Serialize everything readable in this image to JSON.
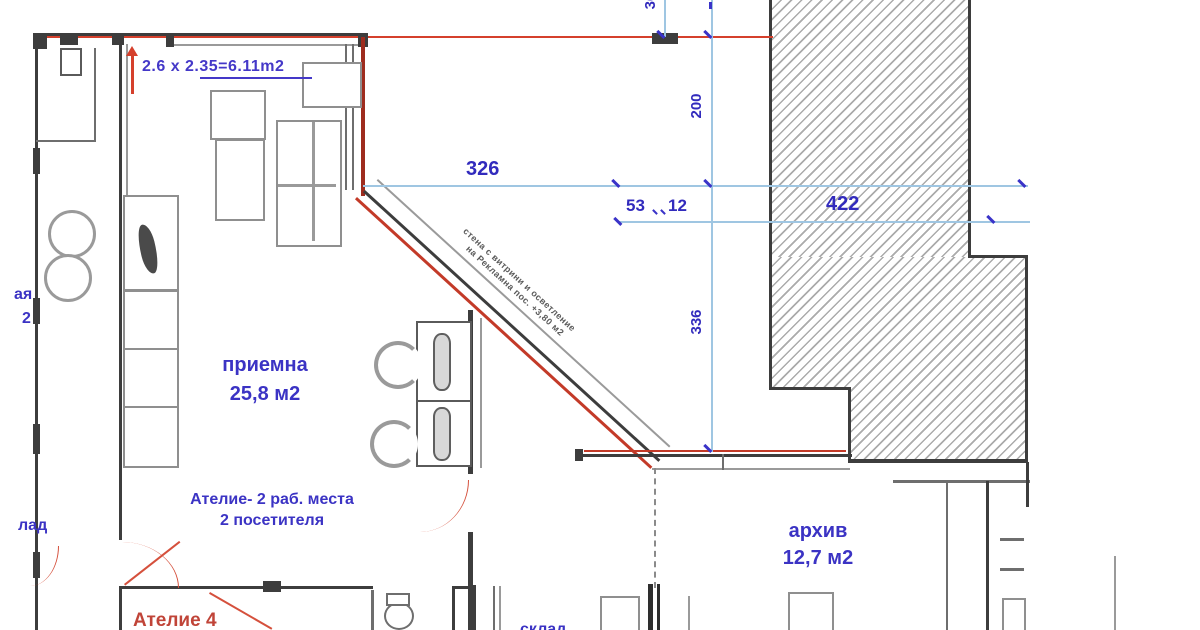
{
  "colors": {
    "dim_line": "#9fc6e2",
    "dim_text": "#322bbd",
    "label_blue": "#3b33c4",
    "red_line": "#d5402c",
    "dark_red": "#9e2c1e",
    "wall": "#3d3d3d",
    "red_text": "#c04438"
  },
  "dimensions": {
    "top_small": "36",
    "width_326": "326",
    "width_53": "53",
    "width_12": "12",
    "width_422": "422",
    "height_200": "200",
    "height_336": "336"
  },
  "annotations": {
    "area_calc": "2.6 x 2.35=6.11m2",
    "diag_note_line1": "стена с витрини и осветление",
    "diag_note_line2": "на Рекламна пос. +3,80 м2"
  },
  "rooms": {
    "reception": {
      "name": "приемна",
      "area": "25,8 м2"
    },
    "atelier": {
      "line1": "Ателие- 2 раб. места",
      "line2": "2 посетителя"
    },
    "archive": {
      "name": "архив",
      "area": "12,7 м2"
    },
    "atelier4": {
      "name": "Ателие 4"
    },
    "cut_left_top": {
      "line1": "ая",
      "line2": "2"
    },
    "cut_left_mid": "лад",
    "cut_bottom": "склад"
  }
}
